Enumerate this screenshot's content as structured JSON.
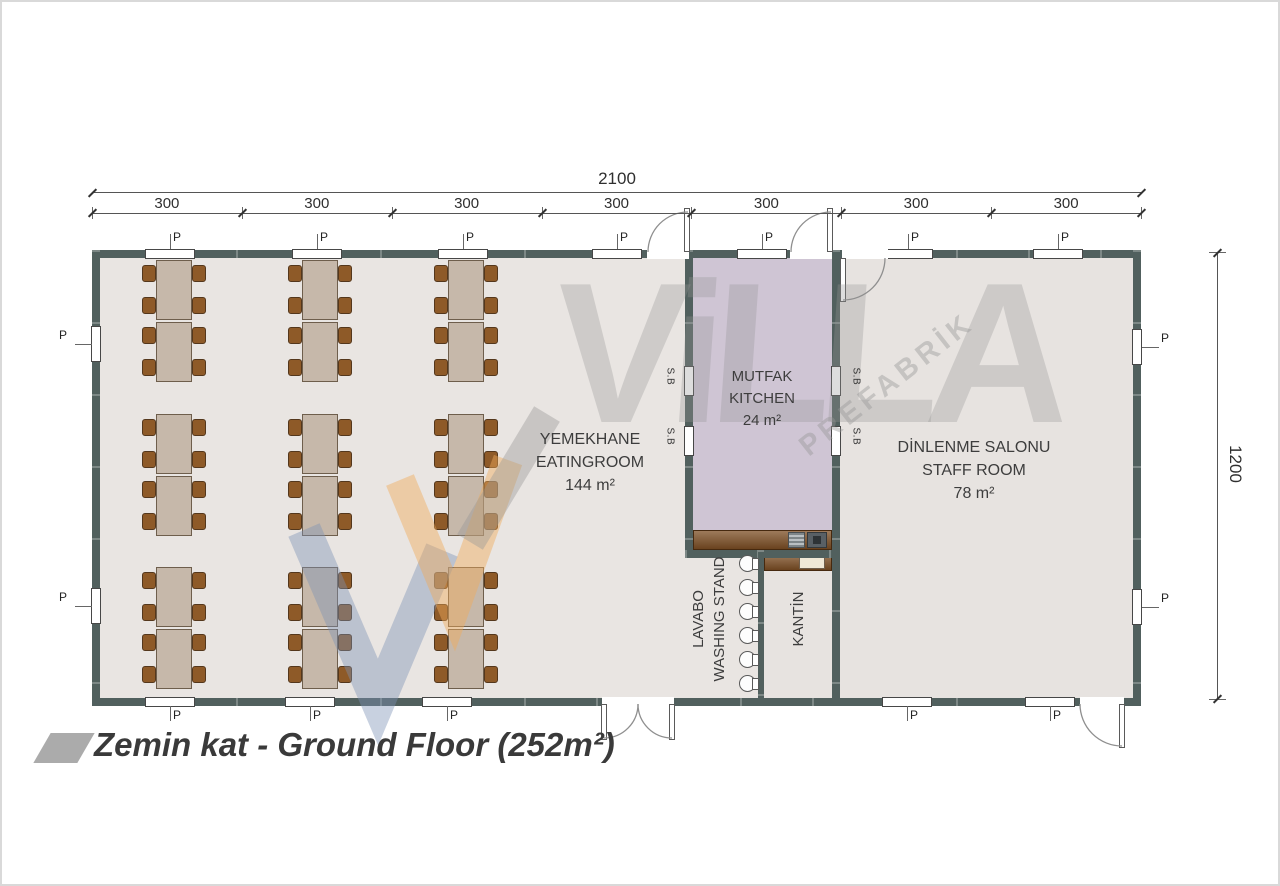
{
  "title": {
    "label": "Zemin kat - Ground Floor (252m²)"
  },
  "dimensions": {
    "total_width": "2100",
    "segments": [
      "300",
      "300",
      "300",
      "300",
      "300",
      "300",
      "300"
    ],
    "height": "1200"
  },
  "rooms": {
    "eatingroom": {
      "name_tr": "YEMEKHANE",
      "name_en": "EATINGROOM",
      "area": "144 m²"
    },
    "kitchen": {
      "name_tr": "MUTFAK",
      "name_en": "KITCHEN",
      "area": "24 m²"
    },
    "staffroom": {
      "name_tr": "DİNLENME SALONU",
      "name_en": "STAFF ROOM",
      "area": "78 m²"
    },
    "washstand": {
      "line1": "LAVABO",
      "line2": "WASHING STAND"
    },
    "canteen": {
      "label": "KANTİN"
    }
  },
  "labels": {
    "window": "P",
    "small_window": "S.B"
  },
  "watermark": {
    "brand": "ViLLA",
    "subbrand": "PREFABRİK"
  },
  "colors": {
    "wall": "#51605e",
    "kitchen_floor": "#cfc5d4",
    "eating_floor": "#e9e5e2",
    "staff_floor": "#e7e3e0",
    "table": "#c6b8aa",
    "chair": "#8e5a28",
    "counter": "#7c4e24",
    "accent_blue": "#7d92b4",
    "accent_orange": "#f0aa5a"
  }
}
